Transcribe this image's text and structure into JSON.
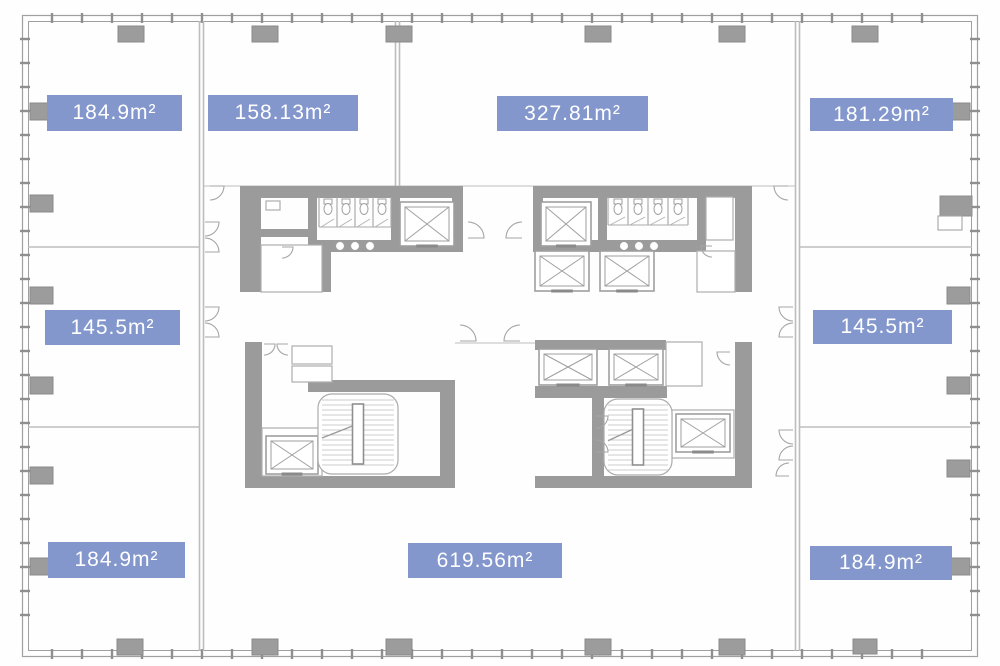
{
  "plan": {
    "type": "office-floor-plan",
    "colors": {
      "label_bg": "#8397cd",
      "label_text": "#ffffff",
      "wall": "#9b9b9b",
      "column": "#9c9c9c",
      "column_stroke": "#8a8a8a",
      "thin_line": "#bdbdbd",
      "outline": "#a0a0a0",
      "tick": "#8f8f8f",
      "symbol_stroke": "#9f9f9f"
    },
    "unit_labels": [
      {
        "id": "top-left",
        "text": "184.9m²",
        "x": 47,
        "y": 95,
        "w": 135,
        "h": 36
      },
      {
        "id": "top-second",
        "text": "158.13m²",
        "x": 208,
        "y": 95,
        "w": 150,
        "h": 36
      },
      {
        "id": "top-center",
        "text": "327.81m²",
        "x": 497,
        "y": 96,
        "w": 151,
        "h": 35
      },
      {
        "id": "top-right",
        "text": "181.29m²",
        "x": 810,
        "y": 98,
        "w": 143,
        "h": 33
      },
      {
        "id": "mid-left",
        "text": "145.5m²",
        "x": 45,
        "y": 310,
        "w": 135,
        "h": 35
      },
      {
        "id": "mid-right",
        "text": "145.5m²",
        "x": 813,
        "y": 310,
        "w": 139,
        "h": 34
      },
      {
        "id": "bottom-left",
        "text": "184.9m²",
        "x": 48,
        "y": 542,
        "w": 137,
        "h": 36
      },
      {
        "id": "bottom-center",
        "text": "619.56m²",
        "x": 408,
        "y": 543,
        "w": 154,
        "h": 35
      },
      {
        "id": "bottom-right",
        "text": "184.9m²",
        "x": 810,
        "y": 546,
        "w": 142,
        "h": 34
      }
    ],
    "columns": [
      [
        118,
        26,
        26,
        16
      ],
      [
        252,
        26,
        26,
        16
      ],
      [
        386,
        26,
        26,
        16
      ],
      [
        585,
        26,
        26,
        16
      ],
      [
        719,
        26,
        26,
        16
      ],
      [
        852,
        26,
        26,
        16
      ],
      [
        117,
        639,
        26,
        16
      ],
      [
        252,
        639,
        26,
        16
      ],
      [
        386,
        639,
        26,
        16
      ],
      [
        585,
        639,
        26,
        16
      ],
      [
        719,
        639,
        26,
        16
      ],
      [
        853,
        639,
        24,
        15
      ],
      [
        30,
        103,
        23,
        17
      ],
      [
        30,
        195,
        23,
        17
      ],
      [
        30,
        287,
        23,
        17
      ],
      [
        30,
        377,
        23,
        17
      ],
      [
        30,
        467,
        23,
        17
      ],
      [
        30,
        558,
        23,
        17
      ],
      [
        947,
        103,
        23,
        17
      ],
      [
        947,
        287,
        23,
        17
      ],
      [
        947,
        377,
        23,
        17
      ],
      [
        947,
        460,
        23,
        17
      ],
      [
        947,
        558,
        23,
        17
      ]
    ],
    "elevators": [
      {
        "name": "elevator-symbol",
        "x": 400,
        "y": 202,
        "w": 54,
        "h": 44
      },
      {
        "name": "elevator-symbol",
        "x": 541,
        "y": 202,
        "w": 50,
        "h": 44
      },
      {
        "name": "elevator-symbol",
        "x": 535,
        "y": 251,
        "w": 54,
        "h": 40
      },
      {
        "name": "elevator-symbol",
        "x": 600,
        "y": 251,
        "w": 54,
        "h": 40
      },
      {
        "name": "elevator-symbol",
        "x": 266,
        "y": 436,
        "w": 52,
        "h": 38
      },
      {
        "name": "elevator-symbol",
        "x": 539,
        "y": 349,
        "w": 58,
        "h": 36
      },
      {
        "name": "elevator-symbol",
        "x": 609,
        "y": 349,
        "w": 54,
        "h": 36
      },
      {
        "name": "elevator-symbol",
        "x": 676,
        "y": 414,
        "w": 54,
        "h": 38
      }
    ],
    "stairs": [
      {
        "name": "staircase-symbol",
        "x": 318,
        "y": 394,
        "w": 80,
        "h": 80
      },
      {
        "name": "staircase-symbol",
        "x": 604,
        "y": 399,
        "w": 68,
        "h": 76
      }
    ],
    "stall_groups": [
      {
        "name": "toilet-stalls",
        "x": 319,
        "y": 197,
        "count": 4,
        "w": 18,
        "depth": 30
      },
      {
        "name": "toilet-stalls",
        "x": 608,
        "y": 197,
        "count": 4,
        "w": 20,
        "depth": 28
      }
    ],
    "sinks": [
      [
        340,
        246
      ],
      [
        355,
        246
      ],
      [
        370,
        246
      ],
      [
        624,
        246
      ],
      [
        639,
        246
      ],
      [
        654,
        246
      ]
    ],
    "rooms": [
      [
        292,
        346,
        40,
        18
      ],
      [
        292,
        366,
        40,
        16
      ],
      [
        666,
        342,
        36,
        44
      ],
      [
        262,
        428,
        60,
        48
      ],
      [
        261,
        245,
        61,
        47
      ],
      [
        706,
        197,
        27,
        43
      ],
      [
        697,
        251,
        38,
        41
      ],
      [
        672,
        410,
        62,
        48
      ],
      [
        266,
        201,
        14,
        9
      ]
    ],
    "doors": [
      {
        "hx": 205,
        "hy": 222,
        "r": 14,
        "a0": 0,
        "a1": 90
      },
      {
        "hx": 205,
        "hy": 252,
        "r": 14,
        "a0": 0,
        "a1": -90
      },
      {
        "hx": 205,
        "hy": 307,
        "r": 14,
        "a0": 0,
        "a1": 90
      },
      {
        "hx": 205,
        "hy": 337,
        "r": 14,
        "a0": 0,
        "a1": -90
      },
      {
        "hx": 793,
        "hy": 307,
        "r": 14,
        "a0": 180,
        "a1": 90
      },
      {
        "hx": 793,
        "hy": 337,
        "r": 14,
        "a0": 180,
        "a1": 270
      },
      {
        "hx": 793,
        "hy": 430,
        "r": 14,
        "a0": 180,
        "a1": 90
      },
      {
        "hx": 793,
        "hy": 460,
        "r": 14,
        "a0": 180,
        "a1": 270
      },
      {
        "hx": 468,
        "hy": 238,
        "r": 16,
        "a0": 0,
        "a1": -90
      },
      {
        "hx": 522,
        "hy": 238,
        "r": 16,
        "a0": 180,
        "a1": 270
      },
      {
        "hx": 460,
        "hy": 341,
        "r": 16,
        "a0": 0,
        "a1": -90
      },
      {
        "hx": 520,
        "hy": 341,
        "r": 16,
        "a0": 180,
        "a1": 270
      },
      {
        "hx": 210,
        "hy": 186,
        "r": 14,
        "a0": 0,
        "a1": 90
      },
      {
        "hx": 788,
        "hy": 186,
        "r": 14,
        "a0": 180,
        "a1": 90
      },
      {
        "hx": 264,
        "hy": 344,
        "r": 11,
        "a0": 0,
        "a1": 90
      },
      {
        "hx": 288,
        "hy": 344,
        "r": 11,
        "a0": 180,
        "a1": 90
      },
      {
        "hx": 730,
        "hy": 352,
        "r": 13,
        "a0": 180,
        "a1": 90
      },
      {
        "hx": 596,
        "hy": 416,
        "r": 12,
        "a0": 0,
        "a1": 90
      },
      {
        "hx": 596,
        "hy": 452,
        "r": 12,
        "a0": 0,
        "a1": -90
      },
      {
        "hx": 789,
        "hy": 476,
        "r": 13,
        "a0": 180,
        "a1": 270
      },
      {
        "hx": 282,
        "hy": 247,
        "r": 11,
        "a0": 0,
        "a1": 90
      },
      {
        "hx": 712,
        "hy": 246,
        "r": 11,
        "a0": 180,
        "a1": 90
      }
    ],
    "shaft": {
      "name": "duct-shaft",
      "x": 940,
      "y": 196
    }
  }
}
